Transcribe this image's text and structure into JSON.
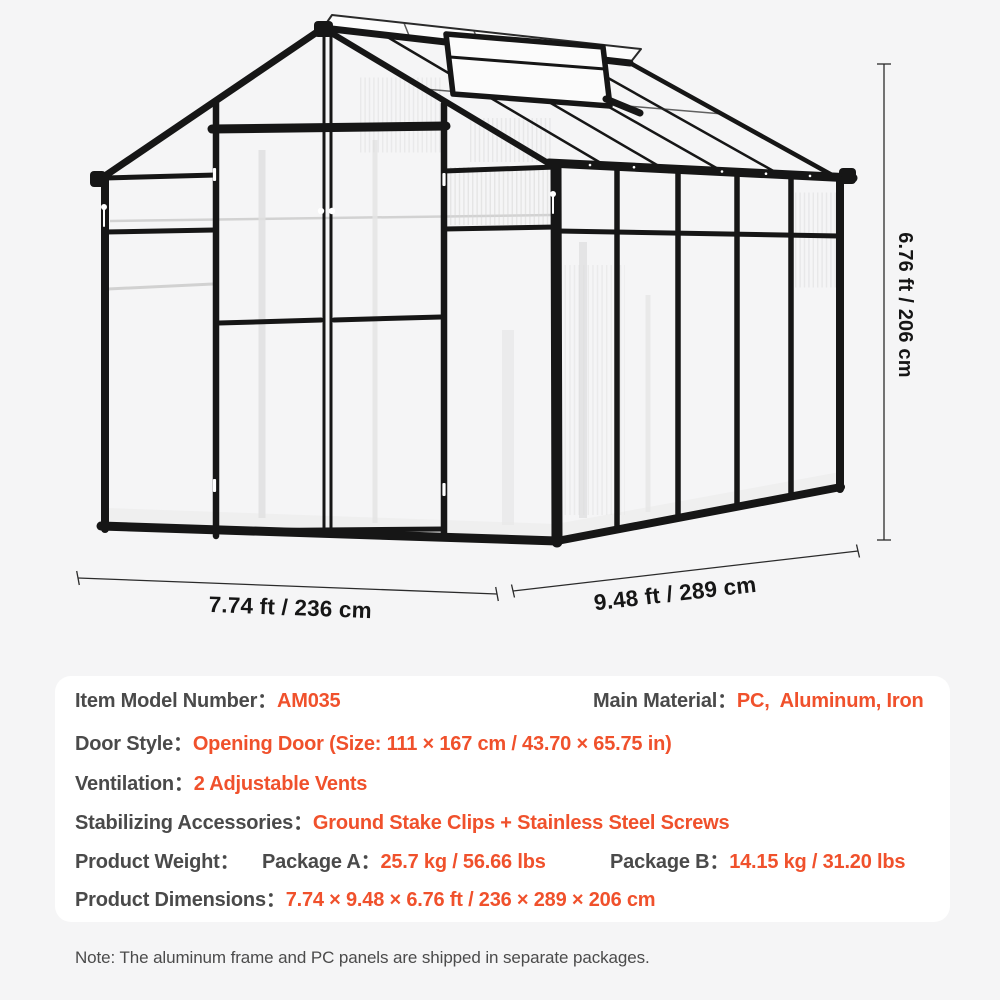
{
  "colors": {
    "accent": "#f0512c",
    "label_gray": "#4a4a4a",
    "frame_black": "#161616",
    "page_bg": "#f5f5f6",
    "panel_bg": "#ffffff"
  },
  "diagram": {
    "height_label": "6.76 ft / 206 cm",
    "width_label": "7.74 ft / 236 cm",
    "depth_label": "9.48 ft / 289 cm"
  },
  "spec": {
    "rows": [
      {
        "cols": [
          {
            "x": 0,
            "segs": [
              {
                "t": "Item Model Number：",
                "k": "label"
              },
              {
                "t": "AM035",
                "k": "value"
              }
            ]
          },
          {
            "x": 518,
            "segs": [
              {
                "t": "Main Material：",
                "k": "label"
              },
              {
                "t": "PC,  Aluminum, Iron",
                "k": "value"
              }
            ]
          }
        ]
      },
      {
        "cols": [
          {
            "x": 0,
            "segs": [
              {
                "t": "Door Style：",
                "k": "label"
              },
              {
                "t": "Opening Door (Size: 111 × 167 cm / 43.70 × 65.75 in)",
                "k": "value"
              }
            ]
          }
        ]
      },
      {
        "cols": [
          {
            "x": 0,
            "segs": [
              {
                "t": "Ventilation：",
                "k": "label"
              },
              {
                "t": "2 Adjustable Vents",
                "k": "value"
              }
            ]
          }
        ]
      },
      {
        "cols": [
          {
            "x": 0,
            "segs": [
              {
                "t": "Stabilizing Accessories：",
                "k": "label"
              },
              {
                "t": "Ground Stake Clips + Stainless Steel Screws",
                "k": "value"
              }
            ]
          }
        ]
      },
      {
        "cols": [
          {
            "x": 0,
            "segs": [
              {
                "t": "Product Weight：",
                "k": "label"
              }
            ]
          },
          {
            "x": 187,
            "segs": [
              {
                "t": "Package A：",
                "k": "label"
              },
              {
                "t": "25.7 kg / 56.66 lbs",
                "k": "value"
              }
            ]
          },
          {
            "x": 535,
            "segs": [
              {
                "t": "Package B：",
                "k": "label"
              },
              {
                "t": "14.15 kg / 31.20 lbs",
                "k": "value"
              }
            ]
          }
        ]
      },
      {
        "cols": [
          {
            "x": 0,
            "segs": [
              {
                "t": "Product Dimensions：",
                "k": "label"
              },
              {
                "t": "7.74 × 9.48 × 6.76 ft / 236 × 289 × 206 cm",
                "k": "value"
              }
            ]
          }
        ]
      }
    ]
  },
  "note": "Note: The aluminum frame and PC panels are shipped in separate packages."
}
